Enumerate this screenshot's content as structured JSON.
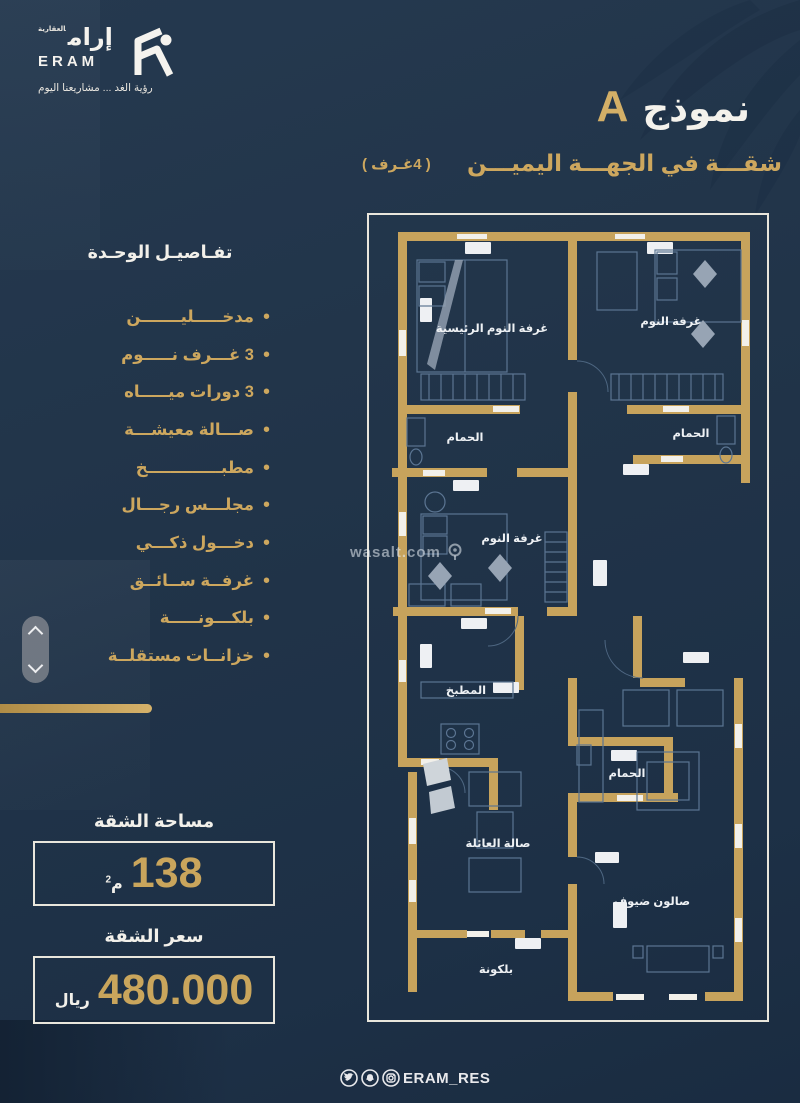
{
  "brand": {
    "name_ar": "إرام",
    "name_ar_tag": "العقارية",
    "name_en": "ERAM",
    "tagline": "رؤية الغد ... مشاريعنا اليوم"
  },
  "header": {
    "title": "نموذج",
    "title_variant": "A",
    "subtitle": "شقـــة في الجهـــة اليميـــن",
    "subtitle_note": "( 4غـرف )"
  },
  "details": {
    "heading": "تفـاصيـل الوحـدة",
    "items": [
      "مدخـــــليـــــــن",
      "3 غـــرف نـــــوم",
      "3 دورات ميـــــاه",
      "صـــالة معيشـــة",
      "مطبـــــــــــــخ",
      "مجلـــس رجـــال",
      "دخـــول ذكـــي",
      "غرفــة ســائــق",
      "بلكـــونـــــة",
      "خزانــات مستقلــة"
    ]
  },
  "area": {
    "label": "مساحة الشقة",
    "value": "138",
    "unit": "م",
    "unit_sup": "2"
  },
  "price": {
    "label": "سعر الشقة",
    "value": "480.000",
    "unit": "ريال"
  },
  "floorplan": {
    "watermark": "wasalt.com",
    "rooms": [
      {
        "name": "غرفة النوم الرئيسية"
      },
      {
        "name": "غرفة النوم"
      },
      {
        "name": "الحمام"
      },
      {
        "name": "الحمام"
      },
      {
        "name": "غرفة النوم"
      },
      {
        "name": "المطبخ"
      },
      {
        "name": "الحمام"
      },
      {
        "name": "صالة العائلة"
      },
      {
        "name": "صالون ضيوف"
      },
      {
        "name": "بلكونة"
      }
    ]
  },
  "footer": {
    "handle": "ERAM_RES"
  },
  "colors": {
    "background": "#213449",
    "wall_gold": "#c7a35c",
    "gold_text": "#cda75e",
    "white": "#f2f0ea"
  }
}
